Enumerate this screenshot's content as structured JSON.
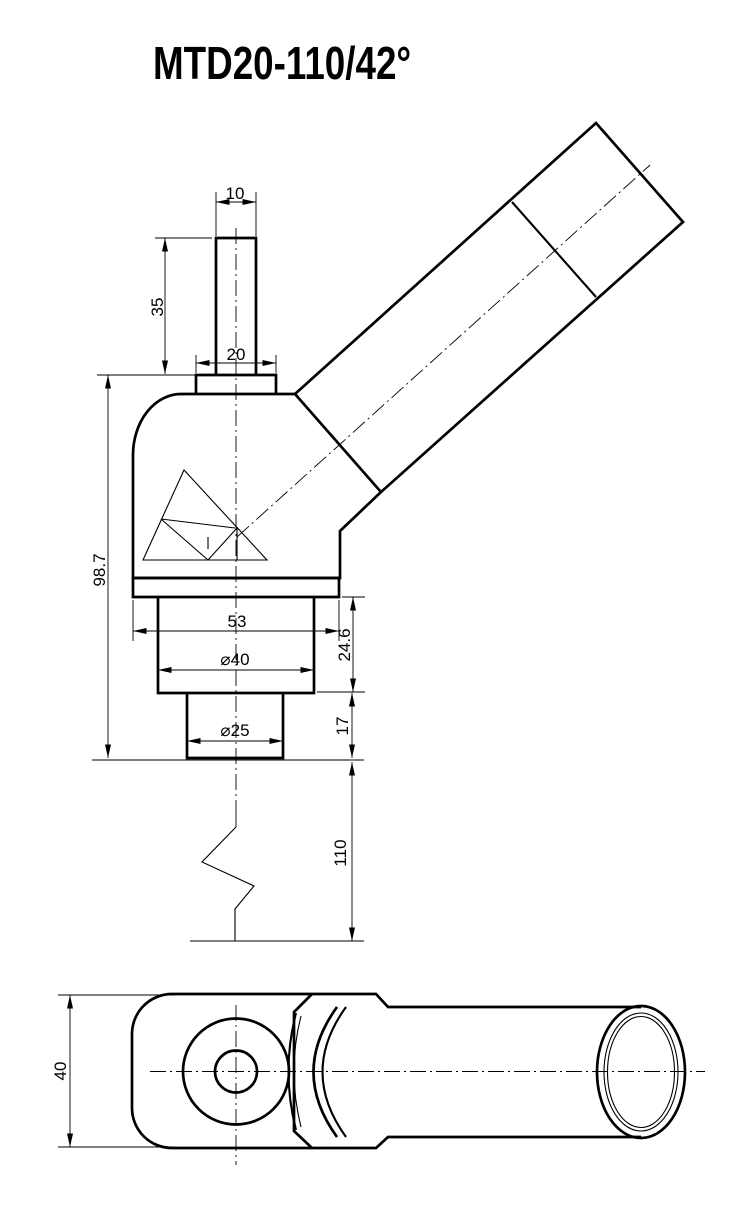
{
  "title": "MTD20-110/42°",
  "colors": {
    "line": "#000000",
    "background": "#ffffff"
  },
  "front_view": {
    "dim_stem_width": "10",
    "dim_stem_height": "35",
    "dim_collar_width": "20",
    "dim_overall_height": "98.7",
    "dim_plate_width": "53",
    "dim_upper_cylinder_dia": "⌀40",
    "dim_upper_cylinder_height": "24.6",
    "dim_lower_cylinder_dia": "⌀25",
    "dim_lower_cylinder_height": "17",
    "dim_post_length": "110"
  },
  "top_view": {
    "dim_body_width": "40"
  }
}
